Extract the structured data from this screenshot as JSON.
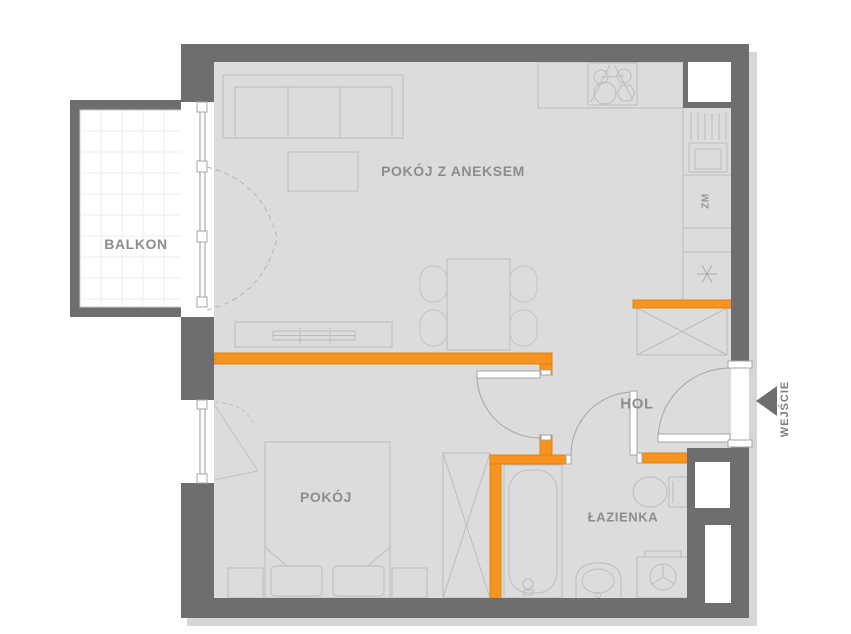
{
  "plan": {
    "title": "apartment-floor-plan",
    "rooms": {
      "living": {
        "label": "POKÓJ Z ANEKSEM"
      },
      "balcony": {
        "label": "BALKON"
      },
      "bedroom": {
        "label": "POKÓJ"
      },
      "hall": {
        "label": "HOL"
      },
      "bathroom": {
        "label": "ŁAZIENKA"
      }
    },
    "entrance": {
      "label": "WEJŚCIE"
    },
    "kitchen": {
      "dishwasher_label": "ZM",
      "fridge_symbol": "✳"
    },
    "colors": {
      "wall": "#6e6e6e",
      "accent_wall": "#f79421",
      "accent_wall_border": "#e0830f",
      "floor": "#dcdcdc",
      "balcony_floor": "#ffffff",
      "furniture_outline": "#bdbdbd",
      "door_line": "#a5a5a5",
      "label_text": "#8d8d8d"
    }
  }
}
